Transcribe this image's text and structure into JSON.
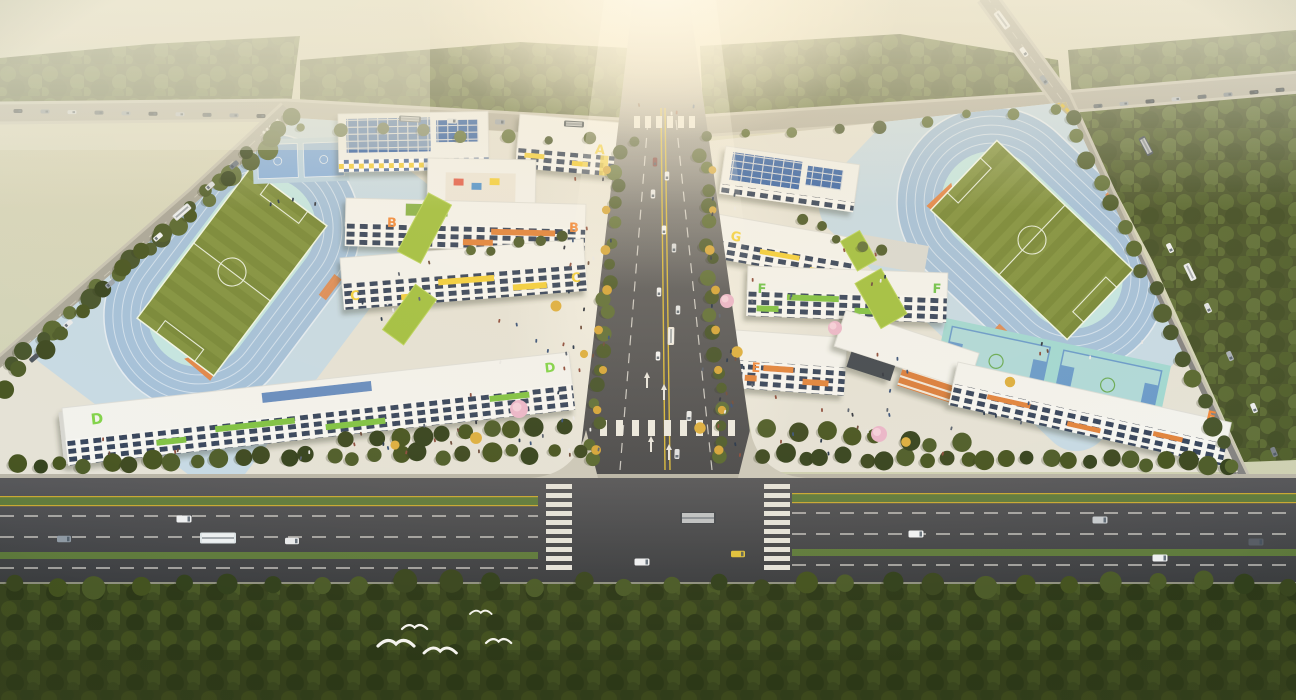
{
  "scene": {
    "title": "Aerial rendering of a twin school campus at sunrise",
    "view": "bird's-eye oblique view, strong sun flare at top center, morning haze over surrounding forest",
    "left_campus": {
      "building_labels": [
        "A",
        "B",
        "C",
        "D"
      ],
      "facilities": [
        "running track",
        "soccer field",
        "basketball courts",
        "courtyard lawns",
        "entry plaza"
      ]
    },
    "right_campus": {
      "building_labels": [
        "E",
        "F",
        "G"
      ],
      "facilities": [
        "running track",
        "soccer field",
        "basketball courts",
        "courtyard lawns",
        "entry plaza"
      ]
    },
    "environment": [
      "perimeter forest belt",
      "tree-lined central avenue",
      "wide boulevard along the bottom",
      "white birds flying over the forest",
      "pink blossom and yellow autumn trees",
      "pedestrians on plazas",
      "cars and buses on every road"
    ]
  },
  "labels": {
    "a": "A",
    "b": "B",
    "c": "C",
    "d": "D",
    "e": "E",
    "f": "F",
    "g": "G"
  },
  "label_colors": {
    "a": "#f2cf3a",
    "b": "#f08a3e",
    "c": "#f2cf3a",
    "d": "#7ed348",
    "e": "#f0863a",
    "f": "#6cc24a",
    "g": "#f2cf3a"
  },
  "colors": {
    "sky_haze": "#dcd9c0",
    "sun_glow": "#fffef5",
    "forest": "#46522a",
    "forest_dark": "#39461f",
    "track_lanes": "#a2c0dc",
    "track_infield": "#c2e6e4",
    "soccer_field": "#7e903e",
    "sprint_zone_orange": "#e08448",
    "asphalt": "#47484b",
    "paving": "#e4e2d8",
    "building_white": "#f2f3f1",
    "solar_panel_blue": "#2e5fa8",
    "lawn": "#9fbf3f",
    "blossom_pink": "#eeb7ce",
    "autumn_yellow": "#d4a539"
  },
  "counts": {
    "building_letter_marks": 12,
    "running_tracks": 2,
    "soccer_fields": 2,
    "birds": 5
  }
}
